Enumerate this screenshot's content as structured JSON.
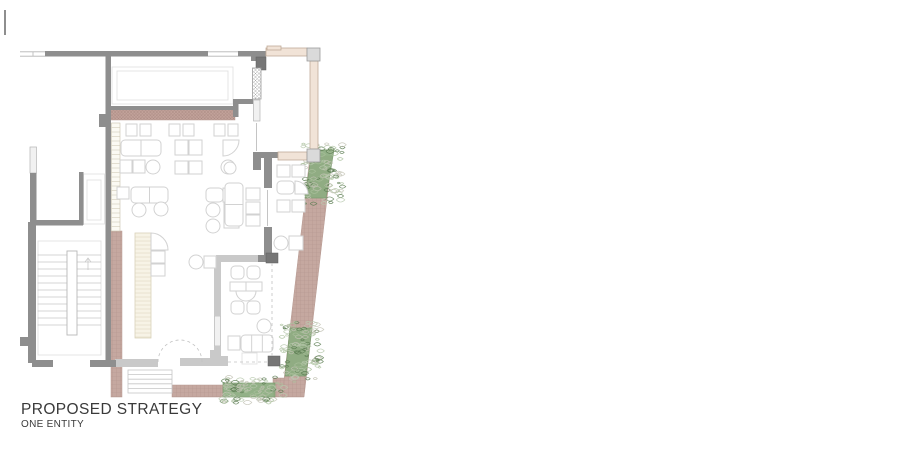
{
  "title": {
    "line1": "PROPOSED STRATEGY",
    "line2": "ONE ENTITY"
  },
  "colors": {
    "wall": "#8e8e8e",
    "wallDark": "#767676",
    "wallLight": "#c9c9c9",
    "windowFill": "#f1f1f1",
    "windowStroke": "#b5b5b5",
    "furn": "#d2d2d2",
    "faint": "#e2e2e2",
    "paving": "#c5a8a0",
    "pavingLine": "#9b7c74",
    "pavingStroke": "#b79a92",
    "bandFill": "#c2a29a",
    "bandLine": "#8d6f68",
    "plant": "#8ead82",
    "plantEdge": "#7a9a6e",
    "plantDark": "#5c7d52",
    "plantLight": "#a9bf9b",
    "cream": "#f1e3d7",
    "creamStroke": "#c0ab98",
    "block": "#dadada",
    "blockStroke": "#9c9c9c",
    "barFill": "#f7f3e6",
    "barStroke": "#d9d2ba",
    "hatch": "#a8a8a8",
    "dash": "#c2c2c2",
    "text": "#3a3a3a"
  },
  "plan": {
    "walls_solid": [
      [
        4,
        10,
        2,
        25
      ],
      [
        45,
        51,
        163,
        5.5
      ],
      [
        238,
        51,
        28,
        5.5
      ],
      [
        251,
        56,
        15,
        5
      ],
      [
        105.5,
        56,
        5.5,
        307
      ],
      [
        99,
        114,
        7,
        13
      ],
      [
        233,
        99,
        5.5,
        18
      ],
      [
        238,
        99,
        15,
        5
      ],
      [
        253,
        152,
        25,
        6
      ],
      [
        253,
        158,
        8,
        12
      ],
      [
        264,
        158,
        8,
        30
      ],
      [
        264,
        227,
        8,
        28
      ],
      [
        258,
        255,
        15,
        7
      ],
      [
        111,
        106,
        124,
        4
      ],
      [
        30,
        173,
        6.5,
        52
      ],
      [
        28,
        222,
        8,
        141
      ],
      [
        32,
        220,
        51,
        5.5
      ],
      [
        79,
        172,
        4.5,
        53
      ],
      [
        20,
        337,
        9,
        9
      ],
      [
        32,
        360,
        21,
        7
      ],
      [
        90,
        360,
        26,
        7
      ]
    ],
    "walls_dark": [
      [
        256,
        57,
        10,
        13
      ],
      [
        266,
        253,
        12,
        10
      ],
      [
        268,
        356,
        12,
        10
      ]
    ],
    "walls_light": [
      [
        216,
        255,
        42,
        7
      ],
      [
        214,
        262,
        7,
        54
      ],
      [
        214,
        346,
        7,
        17
      ],
      [
        214,
        356,
        14,
        7
      ],
      [
        180,
        358,
        48,
        8
      ],
      [
        210,
        350,
        7,
        9
      ],
      [
        115,
        359,
        43,
        8
      ]
    ],
    "windows": [
      [
        30,
        147,
        6.5,
        26
      ],
      [
        105.8,
        150,
        5,
        23
      ],
      [
        253.5,
        100,
        6.5,
        21
      ],
      [
        214.5,
        316,
        6,
        30
      ]
    ],
    "faint_rects": [
      [
        112,
        67,
        121,
        37
      ],
      [
        117,
        71,
        111,
        29
      ],
      [
        83.5,
        174,
        21,
        50
      ],
      [
        87,
        180,
        14,
        40
      ],
      [
        38,
        241,
        63,
        114
      ],
      [
        242,
        353,
        15,
        11
      ]
    ],
    "thin_lines": [
      [
        20,
        51.8,
        45,
        51.8
      ],
      [
        20,
        56.2,
        45,
        56.2
      ],
      [
        33,
        51.8,
        33,
        56.2
      ],
      [
        208,
        51.8,
        238,
        51.8
      ],
      [
        208,
        56.2,
        238,
        56.2
      ],
      [
        267.5,
        190,
        267.5,
        226
      ],
      [
        256.5,
        123,
        256.5,
        151
      ]
    ],
    "dashed_lines": [
      [
        272,
        263,
        272,
        358
      ],
      [
        228,
        362,
        268,
        362
      ]
    ],
    "door_arc": {
      "cx": 180,
      "cy": 362,
      "r": 22
    },
    "band": [
      111,
      110,
      124,
      10
    ],
    "paving_rects": [
      [
        111,
        231,
        11,
        166
      ],
      [
        172,
        385,
        51,
        12
      ],
      [
        273,
        378,
        14,
        19
      ]
    ],
    "paving_polys": [
      [
        [
          310,
          156
        ],
        [
          332,
          156
        ],
        [
          304,
          397
        ],
        [
          282,
          397
        ]
      ]
    ],
    "planters": [
      [
        [
          312,
          150
        ],
        [
          334,
          150
        ],
        [
          326,
          198
        ],
        [
          305,
          198
        ]
      ],
      [
        [
          290,
          328
        ],
        [
          312,
          328
        ],
        [
          306,
          376
        ],
        [
          285,
          376
        ]
      ],
      [
        [
          223,
          383
        ],
        [
          275,
          383
        ],
        [
          275,
          397
        ],
        [
          223,
          397
        ]
      ]
    ],
    "terrace_bars": [
      [
        266,
        48,
        41,
        8
      ],
      [
        310,
        61,
        8,
        88
      ],
      [
        278,
        152,
        29,
        8
      ],
      [
        267,
        46,
        14,
        4
      ]
    ],
    "terrace_columns": [
      [
        307,
        48,
        13,
        13
      ],
      [
        307,
        149,
        13,
        13
      ]
    ],
    "crosshatch_walls": [
      [
        252.5,
        68,
        8.5,
        31
      ]
    ],
    "bar_counter": {
      "x": 135,
      "y": 233,
      "w": 16,
      "h": 105,
      "step": 4
    },
    "ladder_strip": {
      "x": 111.5,
      "y": 123,
      "w": 8.5,
      "h": 108,
      "step": 4.5
    },
    "stairs": {
      "outer": [
        38,
        241,
        63,
        114
      ],
      "stringer": [
        67,
        251,
        10,
        84
      ],
      "y0": 255,
      "dy": 7,
      "n": 11,
      "lx": [
        37.5,
        67
      ],
      "rx": [
        77,
        101
      ],
      "arrow": [
        88,
        270,
        88,
        258
      ]
    },
    "entry_steps": {
      "x": 128,
      "y": 370,
      "w": 44,
      "h": 23,
      "n": 4
    },
    "furniture": [
      {
        "t": "sq",
        "x": 126,
        "y": 124,
        "w": 11,
        "h": 12
      },
      {
        "t": "sq",
        "x": 140,
        "y": 124,
        "w": 11,
        "h": 12
      },
      {
        "t": "sq",
        "x": 169,
        "y": 124,
        "w": 11,
        "h": 12
      },
      {
        "t": "sq",
        "x": 183,
        "y": 124,
        "w": 11,
        "h": 12
      },
      {
        "t": "sq",
        "x": 214,
        "y": 124,
        "w": 11,
        "h": 12
      },
      {
        "t": "sq",
        "x": 228,
        "y": 124,
        "w": 10,
        "h": 12
      },
      {
        "t": "rr",
        "x": 121,
        "y": 140,
        "w": 40,
        "h": 16,
        "div": 1
      },
      {
        "t": "sq",
        "x": 175,
        "y": 140,
        "w": 13,
        "h": 15
      },
      {
        "t": "sq",
        "x": 189,
        "y": 140,
        "w": 13,
        "h": 15
      },
      {
        "t": "q",
        "x": 223,
        "y": 140,
        "s": 16,
        "c": "br"
      },
      {
        "t": "sq",
        "x": 120,
        "y": 160,
        "w": 12,
        "h": 13
      },
      {
        "t": "sq",
        "x": 133,
        "y": 160,
        "w": 12,
        "h": 13
      },
      {
        "t": "c",
        "cx": 153,
        "cy": 167,
        "r": 7
      },
      {
        "t": "sq",
        "x": 175,
        "y": 161,
        "w": 13,
        "h": 13
      },
      {
        "t": "sq",
        "x": 189,
        "y": 161,
        "w": 13,
        "h": 13
      },
      {
        "t": "c",
        "cx": 228,
        "cy": 167,
        "r": 7
      },
      {
        "t": "sq",
        "x": 117,
        "y": 187,
        "w": 12,
        "h": 12
      },
      {
        "t": "rr",
        "x": 131,
        "y": 187,
        "w": 37,
        "h": 16,
        "div": 1
      },
      {
        "t": "c",
        "cx": 139,
        "cy": 210,
        "r": 7
      },
      {
        "t": "c",
        "cx": 161,
        "cy": 209,
        "r": 7
      },
      {
        "t": "rr",
        "x": 206,
        "y": 188,
        "w": 17,
        "h": 14
      },
      {
        "t": "q",
        "x": 223,
        "y": 188,
        "s": 14,
        "c": "tr"
      },
      {
        "t": "c",
        "cx": 213,
        "cy": 210,
        "r": 7
      },
      {
        "t": "c",
        "cx": 213,
        "cy": 226,
        "r": 7
      },
      {
        "t": "sq",
        "x": 224,
        "y": 203,
        "w": 15,
        "h": 12
      },
      {
        "t": "sq",
        "x": 224,
        "y": 216,
        "w": 15,
        "h": 12
      },
      {
        "t": "c",
        "cx": 230,
        "cy": 168,
        "r": 6
      },
      {
        "t": "rr",
        "x": 225,
        "y": 183,
        "w": 18,
        "h": 43,
        "div": 1,
        "divdir": "h"
      },
      {
        "t": "sq",
        "x": 246,
        "y": 188,
        "w": 14,
        "h": 12
      },
      {
        "t": "sq",
        "x": 246,
        "y": 202,
        "w": 14,
        "h": 12
      },
      {
        "t": "sq",
        "x": 246,
        "y": 215,
        "w": 14,
        "h": 11
      },
      {
        "t": "sq",
        "x": 277,
        "y": 165,
        "w": 13,
        "h": 12
      },
      {
        "t": "sq",
        "x": 292,
        "y": 165,
        "w": 13,
        "h": 12
      },
      {
        "t": "rr",
        "x": 277,
        "y": 181,
        "w": 17,
        "h": 13
      },
      {
        "t": "q",
        "x": 295,
        "y": 181,
        "s": 13,
        "c": "tr"
      },
      {
        "t": "sq",
        "x": 277,
        "y": 200,
        "w": 13,
        "h": 12
      },
      {
        "t": "sq",
        "x": 292,
        "y": 200,
        "w": 13,
        "h": 12
      },
      {
        "t": "c",
        "cx": 281,
        "cy": 243,
        "r": 7
      },
      {
        "t": "sq",
        "x": 289,
        "y": 236,
        "w": 14,
        "h": 14
      },
      {
        "t": "rr",
        "x": 231,
        "y": 266,
        "w": 13,
        "h": 13
      },
      {
        "t": "rr",
        "x": 247,
        "y": 266,
        "w": 13,
        "h": 13
      },
      {
        "t": "d",
        "x": 230,
        "y": 282,
        "w": 32,
        "h": 9,
        "r": 10
      },
      {
        "t": "rr",
        "x": 231,
        "y": 301,
        "w": 13,
        "h": 13
      },
      {
        "t": "rr",
        "x": 247,
        "y": 301,
        "w": 13,
        "h": 13
      },
      {
        "t": "c",
        "cx": 264,
        "cy": 326,
        "r": 7
      },
      {
        "t": "sq",
        "x": 228,
        "y": 336,
        "w": 12,
        "h": 14
      },
      {
        "t": "rr",
        "x": 241,
        "y": 335,
        "w": 32,
        "h": 17,
        "div": 2
      },
      {
        "t": "q",
        "x": 151,
        "y": 233,
        "s": 17,
        "c": "tr"
      },
      {
        "t": "sq",
        "x": 151,
        "y": 251,
        "w": 14,
        "h": 12
      },
      {
        "t": "sq",
        "x": 151,
        "y": 264,
        "w": 14,
        "h": 12
      },
      {
        "t": "c",
        "cx": 196,
        "cy": 262,
        "r": 7
      },
      {
        "t": "sq",
        "x": 204,
        "y": 256,
        "w": 12,
        "h": 12
      }
    ]
  }
}
